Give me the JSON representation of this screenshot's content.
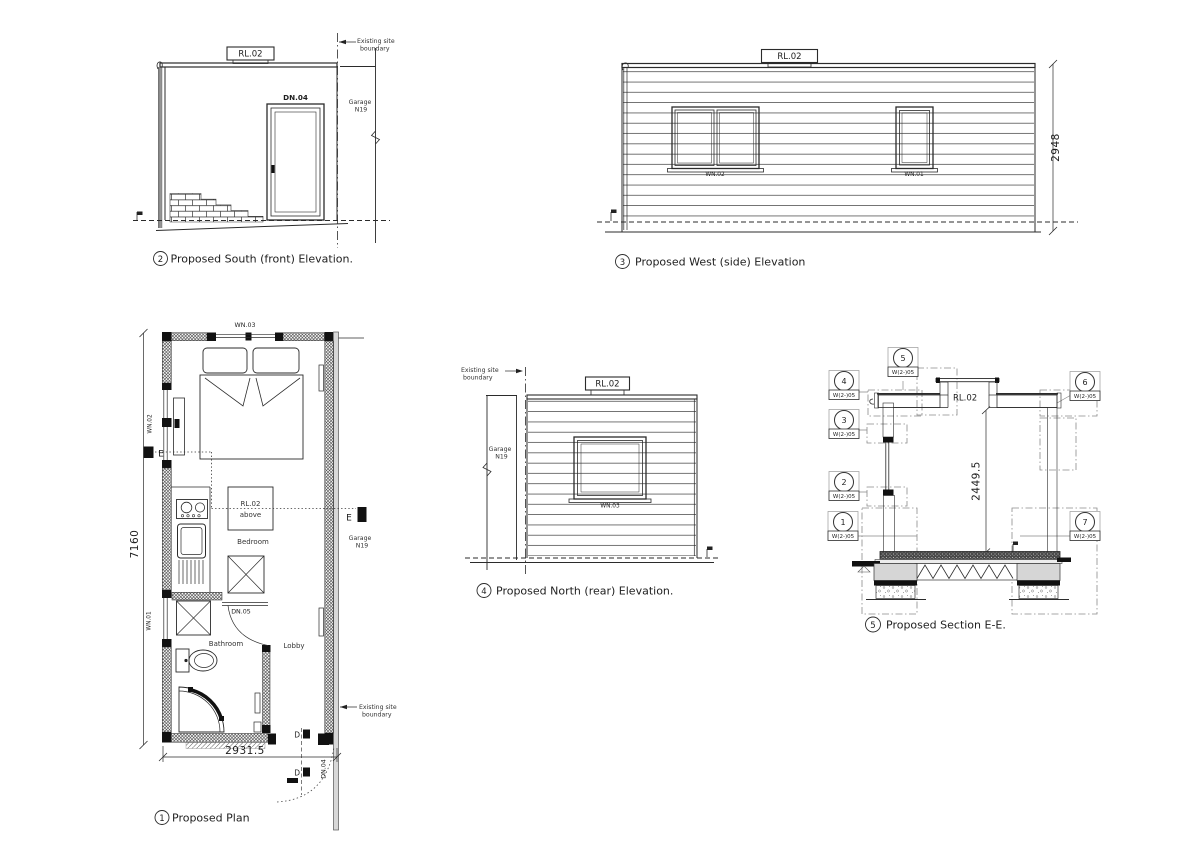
{
  "plan": {
    "num": "1",
    "caption": "Proposed Plan",
    "win_top": "WN.03",
    "win_left_upper": "WN.02",
    "win_left_lower": "WN.01",
    "door_bath": "DN.05",
    "door_entry": "DN.04",
    "rl": "RL.02",
    "rl_sub": "above",
    "bedroom": "Bedroom",
    "bathroom": "Bathroom",
    "lobby": "Lobby",
    "dim_w": "2931.5",
    "dim_h": "7160",
    "marker_e": "E",
    "marker_d": "D",
    "garage1": "Garage",
    "garage2": "N19",
    "bdy1": "Existing site",
    "bdy2": "boundary"
  },
  "south": {
    "num": "2",
    "caption": "Proposed South (front) Elevation.",
    "rl": "RL.02",
    "door": "DN.04",
    "bdy1": "Existing site",
    "bdy2": "boundary",
    "garage1": "Garage",
    "garage2": "N19"
  },
  "west": {
    "num": "3",
    "caption": "Proposed West (side) Elevation",
    "rl": "RL.02",
    "win_l": "WN.02",
    "win_r": "WN.01",
    "dim": "2948"
  },
  "north": {
    "num": "4",
    "caption": "Proposed North (rear) Elevation.",
    "rl": "RL.02",
    "win": "WN.03",
    "bdy1": "Existing site",
    "bdy2": "boundary",
    "garage1": "Garage",
    "garage2": "N19"
  },
  "section": {
    "num": "5",
    "caption": "Proposed Section E-E.",
    "rl": "RL.02",
    "dim": "2449.5",
    "callouts": [
      {
        "num": "1",
        "ref": "W(2-)05"
      },
      {
        "num": "2",
        "ref": "W(2-)05"
      },
      {
        "num": "3",
        "ref": "W(2-)05"
      },
      {
        "num": "4",
        "ref": "W(2-)05"
      },
      {
        "num": "5",
        "ref": "W(2-)05"
      },
      {
        "num": "6",
        "ref": "W(2-)05"
      },
      {
        "num": "7",
        "ref": "W(2-)05"
      }
    ]
  }
}
